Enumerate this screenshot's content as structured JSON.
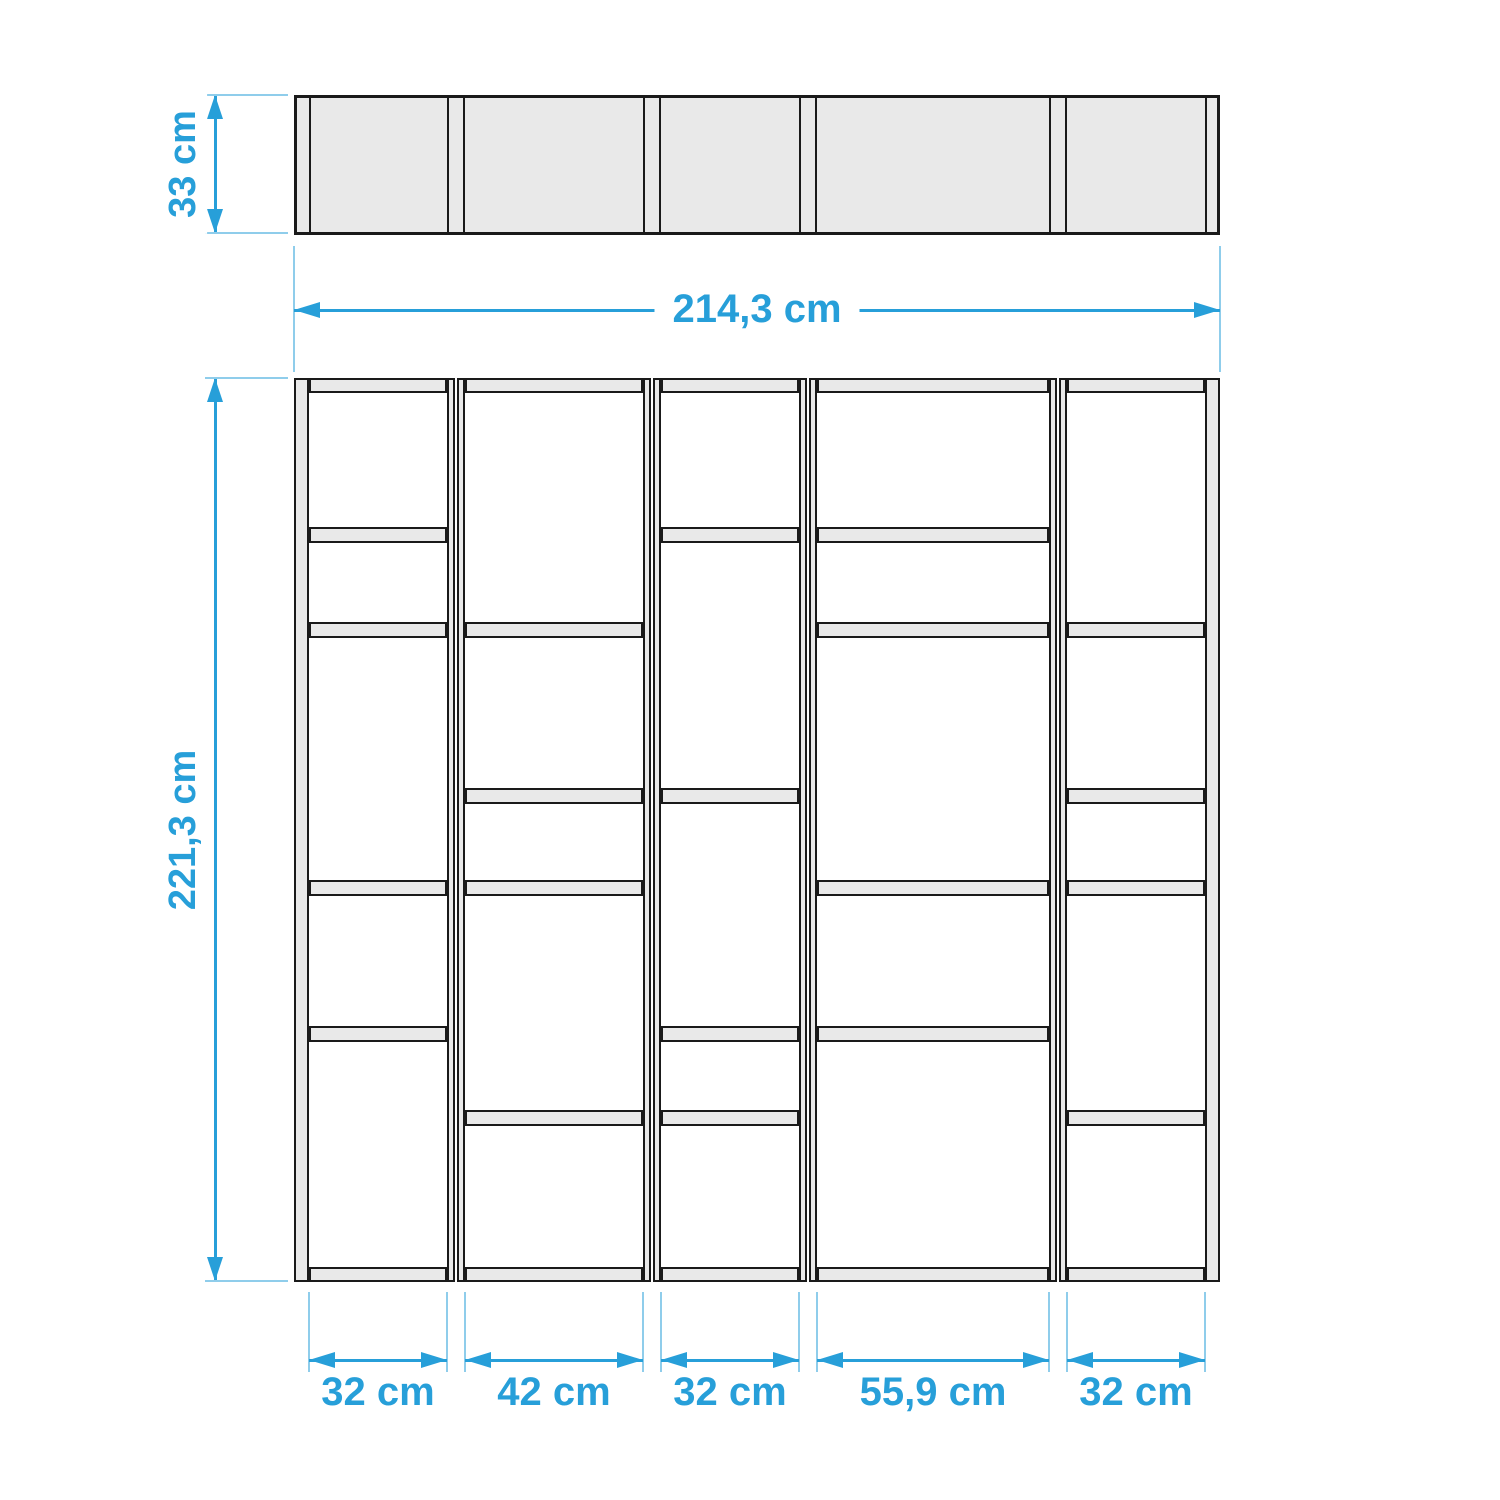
{
  "view": {
    "width": 1500,
    "height": 1500,
    "background": "#FFFFFF"
  },
  "colors": {
    "accent": "#279FD9",
    "extension_line": "#8FCDEB",
    "outline": "#1A1A1A",
    "panel_fill": "#E9E9E9",
    "background": "#FFFFFF"
  },
  "plan_view": {
    "left": 294,
    "top": 95,
    "right": 1220,
    "bottom": 235,
    "side_panel_lines": [
      309,
      1205
    ],
    "divider_line_pairs": [
      [
        447,
        465
      ],
      [
        643,
        661
      ],
      [
        799,
        817
      ],
      [
        1049,
        1067
      ]
    ]
  },
  "front_view": {
    "left": 294,
    "top": 378,
    "right": 1220,
    "bottom": 1282,
    "beam_thickness": 15,
    "shelf_thickness": 16,
    "post_width": 8,
    "walls": [
      [
        294,
        309
      ],
      [
        1205,
        1220
      ]
    ],
    "dividers": [
      [
        447,
        465
      ],
      [
        643,
        661
      ],
      [
        799,
        817
      ],
      [
        1049,
        1067
      ]
    ],
    "columns": [
      {
        "x0": 309,
        "x1": 447,
        "shelves_y": [
          527,
          622,
          880,
          1026
        ]
      },
      {
        "x0": 465,
        "x1": 643,
        "shelves_y": [
          622,
          788,
          880,
          1110
        ]
      },
      {
        "x0": 661,
        "x1": 799,
        "shelves_y": [
          527,
          788,
          1026,
          1110
        ]
      },
      {
        "x0": 817,
        "x1": 1049,
        "shelves_y": [
          527,
          622,
          880,
          1026
        ]
      },
      {
        "x0": 1067,
        "x1": 1205,
        "shelves_y": [
          622,
          788,
          880,
          1110
        ]
      }
    ]
  },
  "dimensions": {
    "depth": {
      "label": "33 cm",
      "line_x": 215,
      "y0": 95,
      "y1": 233,
      "label_cx": 184,
      "label_cy": 164,
      "tick_x0": 205,
      "tick_x1": 288
    },
    "height": {
      "label": "221,3 cm",
      "line_x": 215,
      "y0": 378,
      "y1": 1281,
      "label_cx": 184,
      "label_cy": 830,
      "tick_x0": 205,
      "tick_x1": 288
    },
    "width": {
      "label": "214,3 cm",
      "line_y": 310,
      "x0": 294,
      "x1": 1220,
      "label_cx": 757,
      "label_cy": 309,
      "tick_y0": 246,
      "tick_y1": 372
    },
    "columns": [
      {
        "label": "32 cm",
        "x0": 309,
        "x1": 447
      },
      {
        "label": "42 cm",
        "x0": 465,
        "x1": 643
      },
      {
        "label": "32 cm",
        "x0": 661,
        "x1": 799
      },
      {
        "label": "55,9 cm",
        "x0": 817,
        "x1": 1049
      },
      {
        "label": "32 cm",
        "x0": 1067,
        "x1": 1205
      }
    ],
    "columns_line_y": 1360,
    "columns_label_cy": 1392,
    "columns_tick_y0": 1292,
    "columns_tick_y1": 1372
  }
}
